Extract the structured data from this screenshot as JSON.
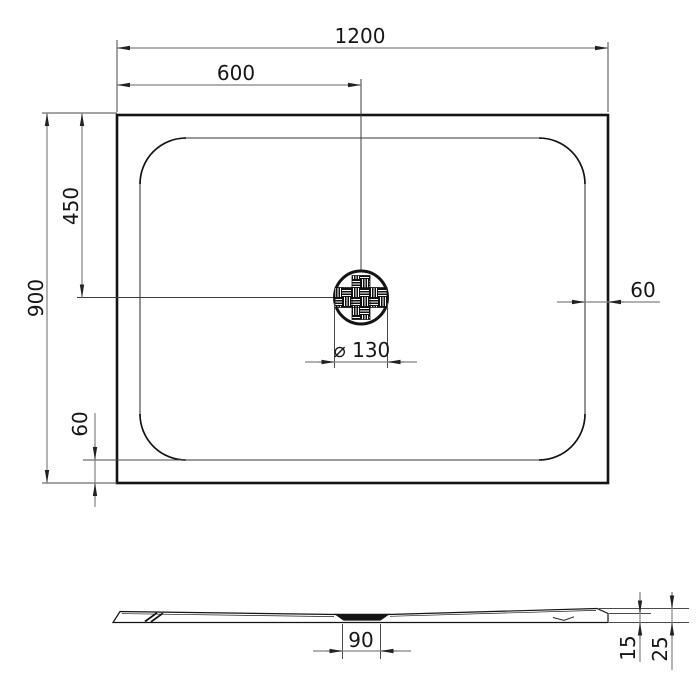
{
  "drawing": {
    "top_view": {
      "width_total": "1200",
      "drain_offset_x": "600",
      "drain_offset_y": "450",
      "height_total": "900",
      "rim_right": "60",
      "rim_bottom": "60",
      "drain_diameter": "⌀ 130"
    },
    "side_view": {
      "drain_recess_width": "90",
      "edge_height": "15",
      "total_height": "25"
    },
    "colors": {
      "background": "#ffffff",
      "main_line": "#141414",
      "dimension_line": "#828282",
      "extension_line": "#4a4a4a",
      "arrow": "#222222",
      "inner_basin_line": "#7a7a7a"
    }
  }
}
